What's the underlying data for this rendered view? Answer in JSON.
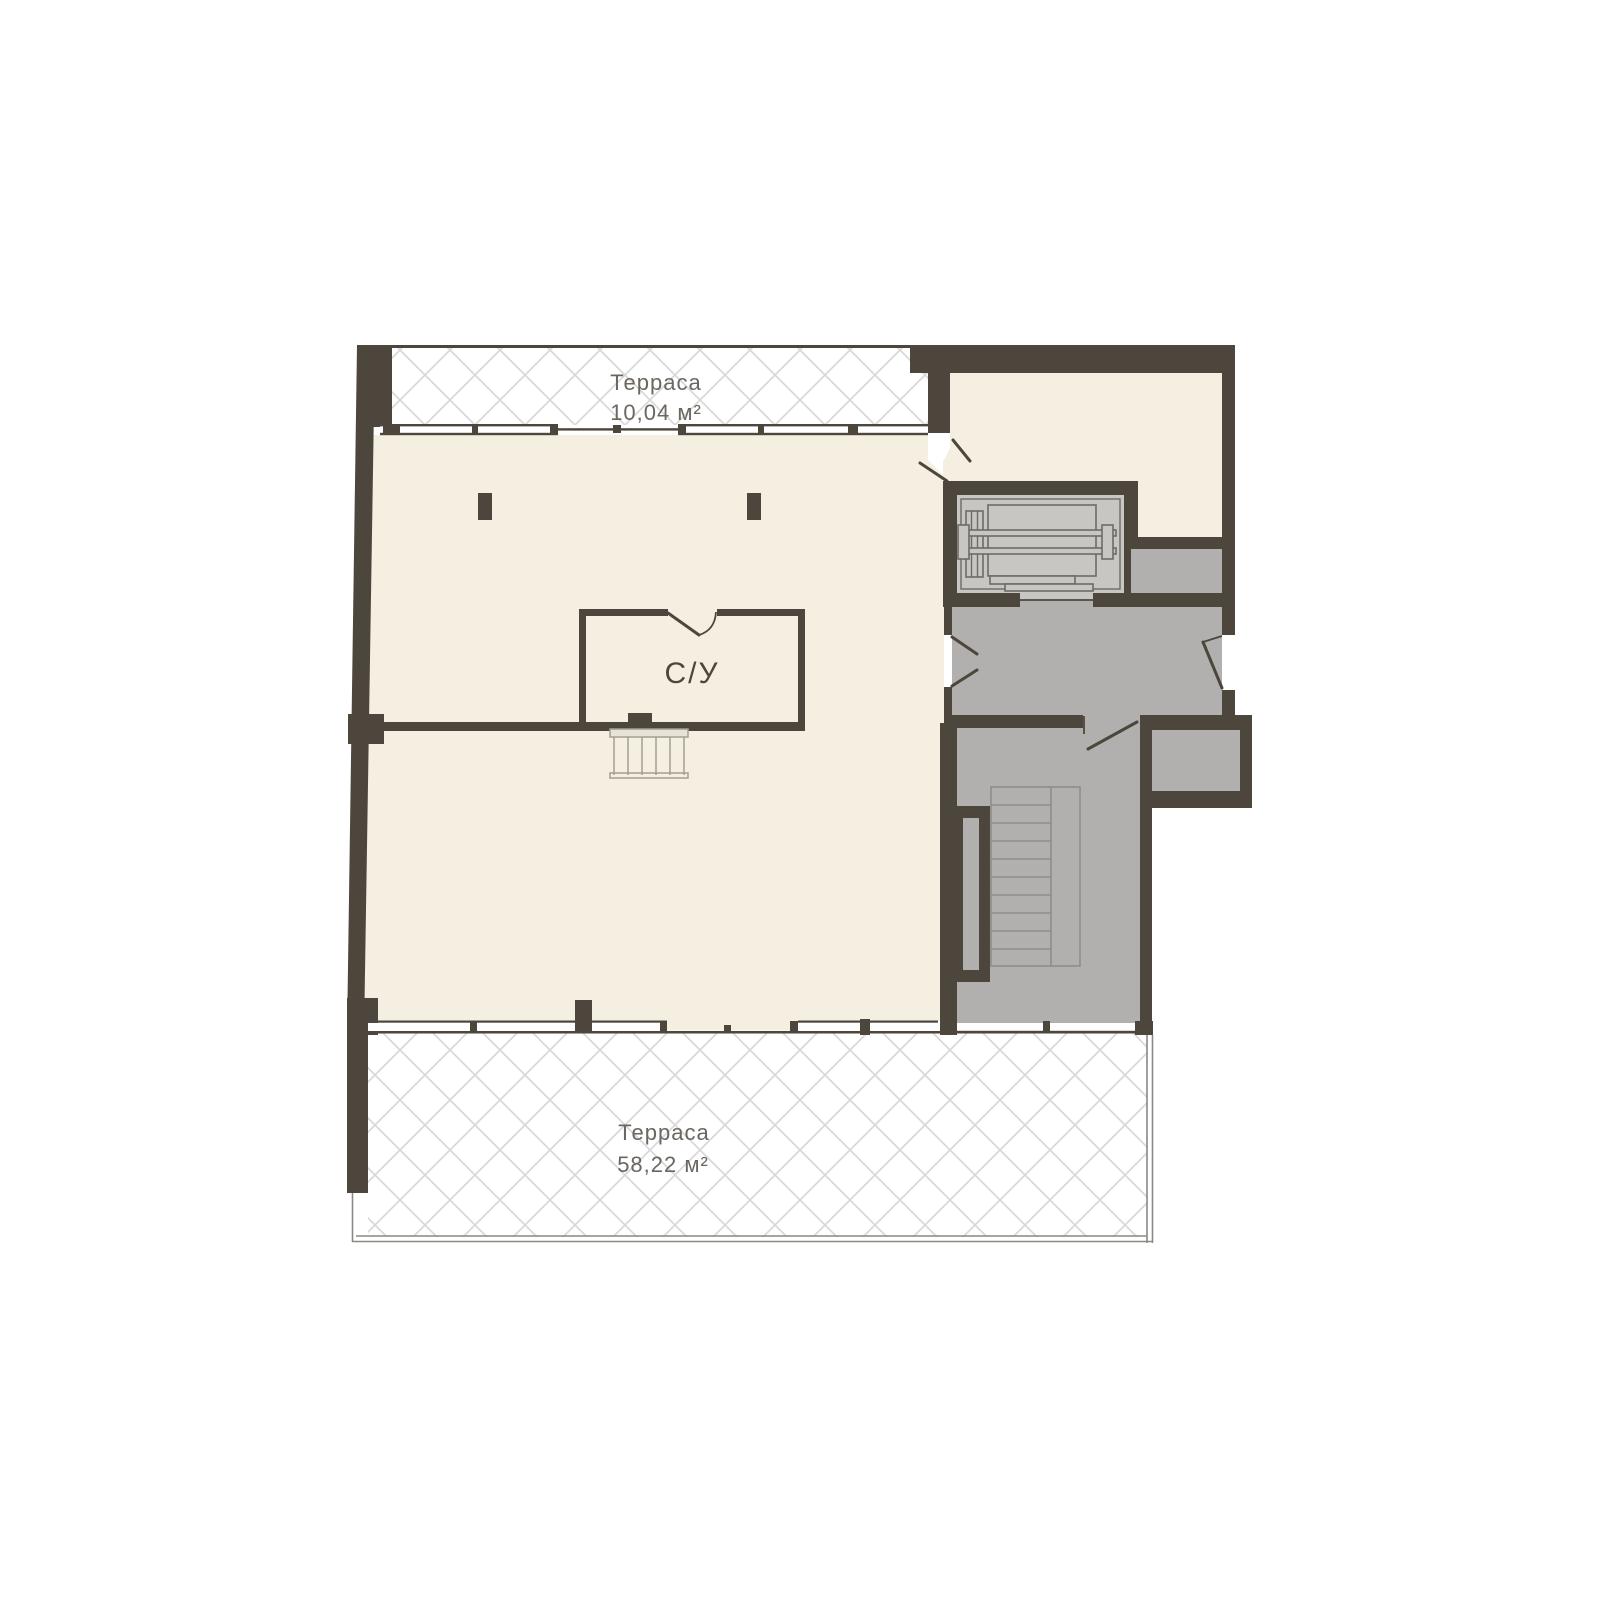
{
  "plan": {
    "rooms": {
      "terrace_top": {
        "name": "Терраса",
        "area": "10,04 м²"
      },
      "terrace_bottom": {
        "name": "Терраса",
        "area": "58,22 м²"
      },
      "bathroom": {
        "name": "С/У"
      }
    },
    "colors": {
      "wall": "#4d463d",
      "floor_cream": "#f5efe2",
      "floor_gray": "#b1b0ae",
      "floor_gray_light": "#c7c6c3",
      "hatch_line": "#d9d9d9",
      "background": "#ffffff"
    }
  }
}
